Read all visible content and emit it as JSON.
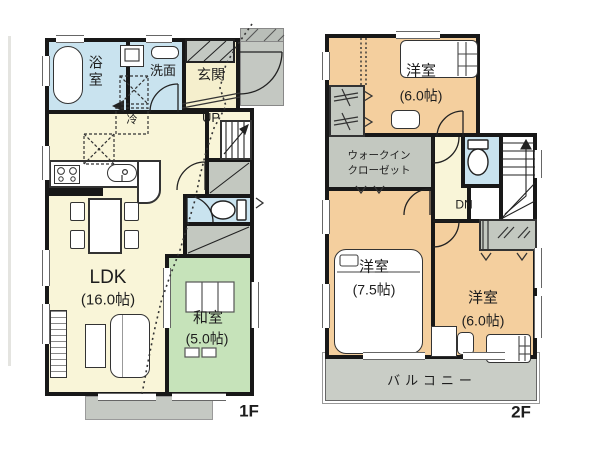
{
  "floors": [
    {
      "label": "1F",
      "rooms": {
        "bath": "浴室",
        "washroom": "洗面",
        "entrance": "玄関",
        "stairs": "UP",
        "refrigerator": "冷",
        "ldk": {
          "name": "LDK",
          "size": "(16.0帖)"
        },
        "japanese_room": {
          "name": "和室",
          "size": "(5.0帖)"
        }
      }
    },
    {
      "label": "2F",
      "rooms": {
        "bedroom_top": {
          "name": "洋室",
          "size": "(6.0帖)"
        },
        "walk_in_closet": {
          "line1": "ウォークイン",
          "line2": "クローゼット"
        },
        "stairs": "DN",
        "bedroom_left": {
          "name": "洋室",
          "size": "(7.5帖)"
        },
        "bedroom_right": {
          "name": "洋室",
          "size": "(6.0帖)"
        },
        "balcony": "バルコニー"
      }
    }
  ],
  "colors": {
    "wall": "#181818",
    "wet_area_blue": "#c9e3ef",
    "living_cream": "#f9f5d8",
    "entrance_tile": "#f5efcd",
    "tatami_green": "#c6e3ba",
    "bedroom_tan": "#f4cf9e",
    "closet_gray": "#c3c8c0",
    "balcony_gray": "#c9cdc6"
  }
}
